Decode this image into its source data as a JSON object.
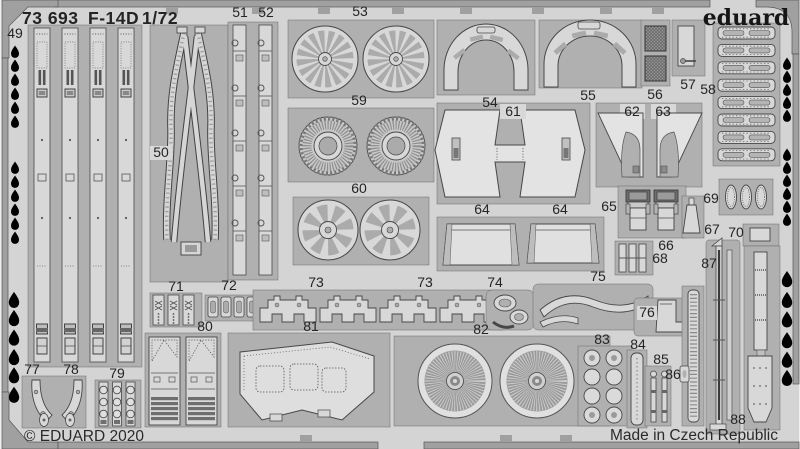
{
  "header": {
    "catalog": "73 693",
    "model": "F-14D",
    "scale": "1/72"
  },
  "brand": {
    "logo": "eduard"
  },
  "footer": {
    "copyright": "© EDUARD 2020",
    "origin": "Made in Czech Republic"
  },
  "colors": {
    "sheet_bg": "#d4d4d4",
    "panel": "#b0b0b0",
    "part": "#d8d8d8",
    "frame": "#a0a0a0",
    "dark_detail": "#6f6f6f",
    "text": "#242424"
  },
  "sheet": {
    "part_number_range": "49–88",
    "labels": {
      "p49": "49",
      "p50": "50",
      "p51": "51",
      "p52": "52",
      "p53": "53",
      "p54": "54",
      "p55": "55",
      "p56": "56",
      "p57": "57",
      "p58": "58",
      "p59": "59",
      "p60": "60",
      "p61": "61",
      "p62": "62",
      "p63": "63",
      "p64a": "64",
      "p64b": "64",
      "p65": "65",
      "p66": "66",
      "p67": "67",
      "p68": "68",
      "p69": "69",
      "p70": "70",
      "p71": "71",
      "p72": "72",
      "p73a": "73",
      "p73b": "73",
      "p74": "74",
      "p75": "75",
      "p76": "76",
      "p77": "77",
      "p78": "78",
      "p79": "79",
      "p80": "80",
      "p81": "81",
      "p82": "82",
      "p83": "83",
      "p84": "84",
      "p85": "85",
      "p86": "86",
      "p87": "87",
      "p88": "88"
    }
  }
}
